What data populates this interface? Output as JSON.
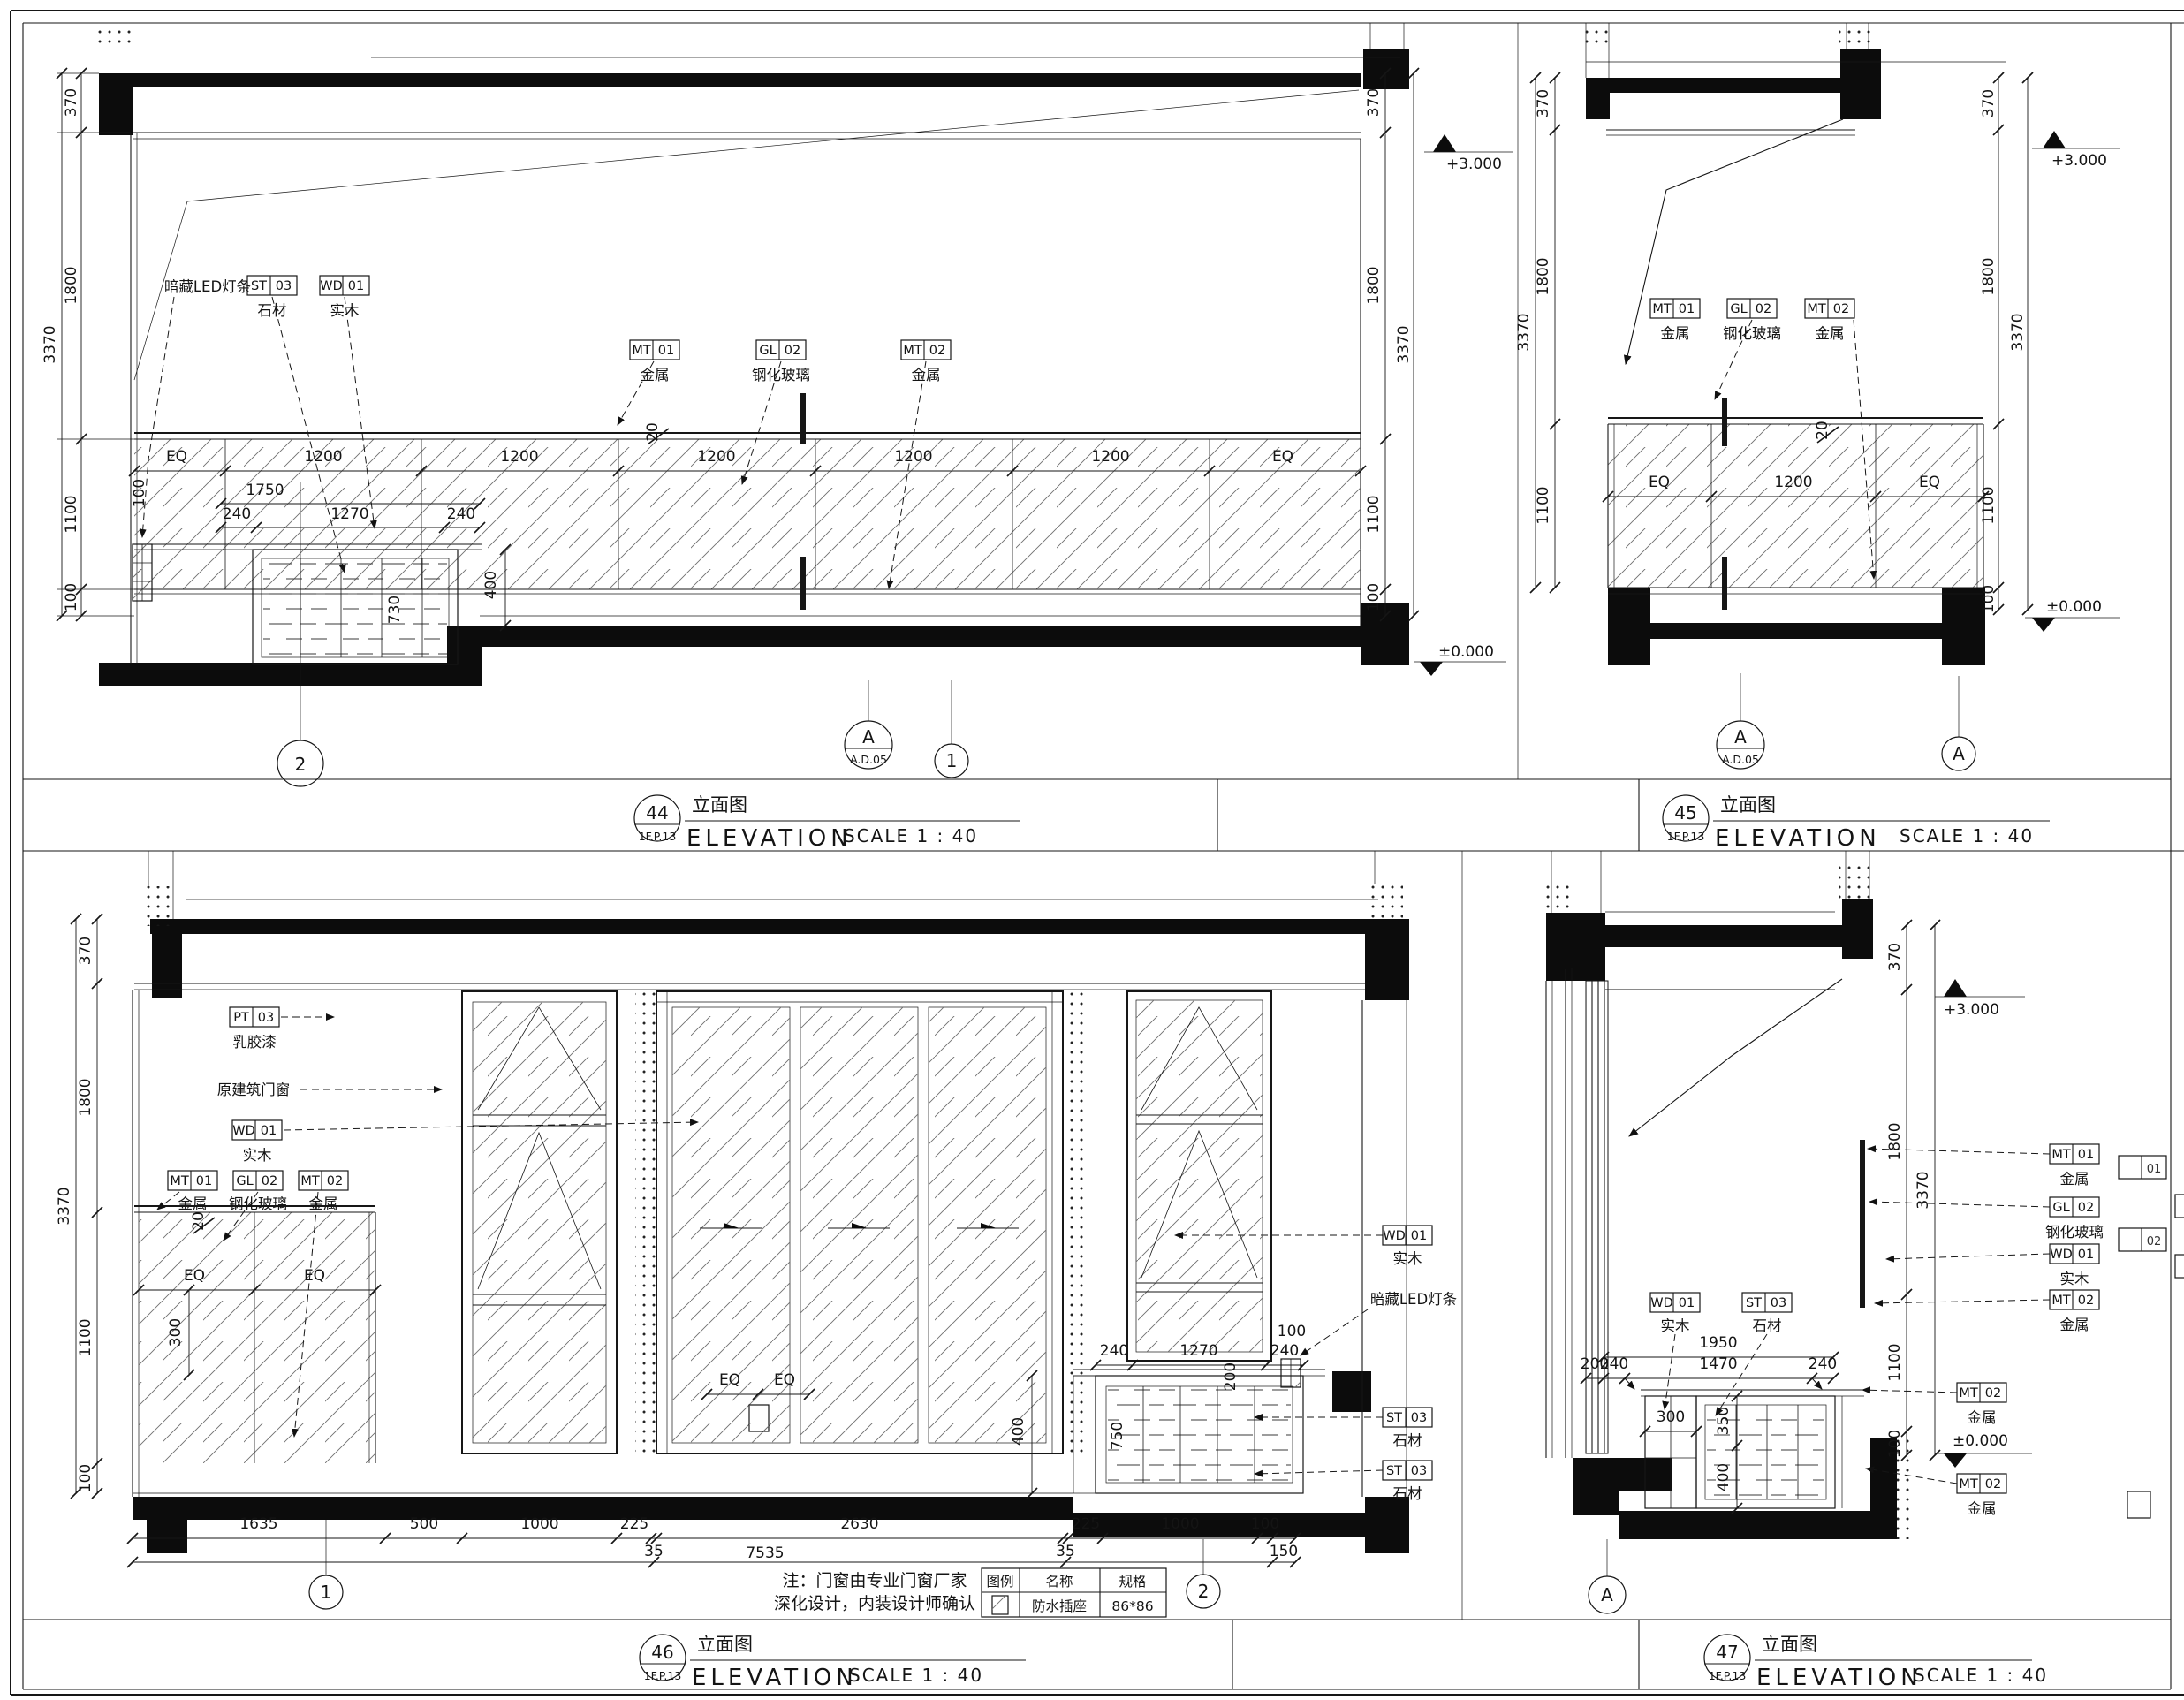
{
  "drawing": {
    "panels": {
      "p44": {
        "num": "44",
        "ref": "1F.P.13"
      },
      "p45": {
        "num": "45",
        "ref": "1F.P.13"
      },
      "p46": {
        "num": "46",
        "ref": "1F.P.13"
      },
      "p47": {
        "num": "47",
        "ref": "1F.P.13"
      }
    },
    "title": {
      "cn": "立面图",
      "en": "ELEVATION",
      "scale": "SCALE 1 : 40"
    },
    "note": {
      "line1": "注：门窗由专业门窗厂家",
      "line2": "深化设计，内装设计师确认"
    },
    "legend": {
      "col_symbol": "图例",
      "col_name": "名称",
      "col_spec": "规格",
      "row_name": "防水插座",
      "row_spec": "86*86"
    },
    "levels": {
      "top": "+3.000",
      "zero": "±0.000"
    },
    "materials": {
      "mt": "MT",
      "gl": "GL",
      "wd": "WD",
      "st": "ST",
      "pt": "PT",
      "c01": "01",
      "c02": "02",
      "c03": "03",
      "metal": "金属",
      "tempered_glass": "钢化玻璃",
      "wood": "实木",
      "stone": "石材",
      "paint": "乳胶漆",
      "hidden_led": "暗藏LED灯条",
      "original_window": "原建筑门窗"
    },
    "dims": {
      "d20": "20",
      "d35": "35",
      "d100": "100",
      "d150": "150",
      "d200": "200",
      "d225": "225",
      "d240": "240",
      "d300": "300",
      "d350": "350",
      "d370": "370",
      "d400": "400",
      "d500": "500",
      "d730": "730",
      "d750": "750",
      "d1000": "1000",
      "d1100": "1100",
      "d1200": "1200",
      "d1270": "1270",
      "d1470": "1470",
      "d1635": "1635",
      "d1750": "1750",
      "d1800": "1800",
      "d1950": "1950",
      "d2630": "2630",
      "d3370": "3370",
      "d7535": "7535",
      "eq": "EQ"
    },
    "axes": {
      "a": "A",
      "n1": "1",
      "n2": "2",
      "detail": "A.D.05"
    },
    "fragments": {
      "f01": "01",
      "f02": "02"
    }
  }
}
